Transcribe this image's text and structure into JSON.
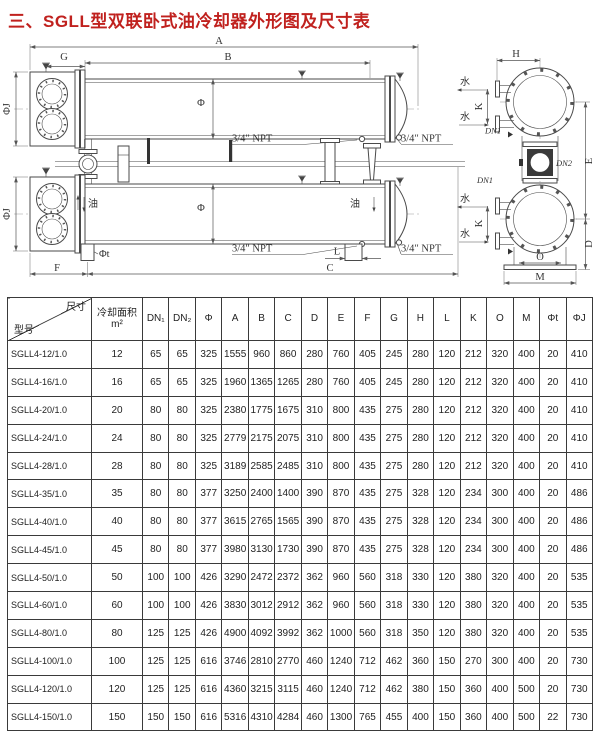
{
  "header": {
    "title": "三、SGLL型双联卧式油冷却器外形图及尺寸表",
    "title_color": "#c0211e"
  },
  "colors": {
    "line": "#4a4a4a",
    "table_border": "#3a3a3a",
    "background": "#ffffff"
  },
  "diagram": {
    "labels": {
      "A": "A",
      "B": "B",
      "G": "G",
      "C": "C",
      "F": "F",
      "L": "L",
      "H": "H",
      "K": "K",
      "D": "D",
      "E": "E",
      "O": "O",
      "M": "M",
      "phi": "Φ",
      "phiJ": "ΦJ",
      "phiT": "Φt",
      "dn1": "DN1",
      "dn2": "DN2",
      "npt": "3/4″ NPT",
      "water": "水",
      "oil": "油"
    }
  },
  "table": {
    "corner": {
      "top": "尺寸",
      "bottom": "型号"
    },
    "area_header": {
      "line1": "冷却面积",
      "line2": "m²"
    },
    "columns": [
      "DN₁",
      "DN₂",
      "Φ",
      "A",
      "B",
      "C",
      "D",
      "E",
      "F",
      "G",
      "H",
      "L",
      "K",
      "O",
      "M",
      "Φt",
      "ΦJ"
    ],
    "rows": [
      {
        "model": "SGLL4-12/1.0",
        "values": [
          12,
          65,
          65,
          325,
          1555,
          960,
          860,
          280,
          760,
          405,
          245,
          280,
          120,
          212,
          320,
          400,
          20,
          410
        ]
      },
      {
        "model": "SGLL4-16/1.0",
        "values": [
          16,
          65,
          65,
          325,
          1960,
          1365,
          1265,
          280,
          760,
          405,
          245,
          280,
          120,
          212,
          320,
          400,
          20,
          410
        ]
      },
      {
        "model": "SGLL4-20/1.0",
        "values": [
          20,
          80,
          80,
          325,
          2380,
          1775,
          1675,
          310,
          800,
          435,
          275,
          280,
          120,
          212,
          320,
          400,
          20,
          410
        ]
      },
      {
        "model": "SGLL4-24/1.0",
        "values": [
          24,
          80,
          80,
          325,
          2779,
          2175,
          2075,
          310,
          800,
          435,
          275,
          280,
          120,
          212,
          320,
          400,
          20,
          410
        ]
      },
      {
        "model": "SGLL4-28/1.0",
        "values": [
          28,
          80,
          80,
          325,
          3189,
          2585,
          2485,
          310,
          800,
          435,
          275,
          280,
          120,
          212,
          320,
          400,
          20,
          410
        ]
      },
      {
        "model": "SGLL4-35/1.0",
        "values": [
          35,
          80,
          80,
          377,
          3250,
          2400,
          1400,
          390,
          870,
          435,
          275,
          328,
          120,
          234,
          300,
          400,
          20,
          486
        ]
      },
      {
        "model": "SGLL4-40/1.0",
        "values": [
          40,
          80,
          80,
          377,
          3615,
          2765,
          1565,
          390,
          870,
          435,
          275,
          328,
          120,
          234,
          300,
          400,
          20,
          486
        ]
      },
      {
        "model": "SGLL4-45/1.0",
        "values": [
          45,
          80,
          80,
          377,
          3980,
          3130,
          1730,
          390,
          870,
          435,
          275,
          328,
          120,
          234,
          300,
          400,
          20,
          486
        ]
      },
      {
        "model": "SGLL4-50/1.0",
        "values": [
          50,
          100,
          100,
          426,
          3290,
          2472,
          2372,
          362,
          960,
          560,
          318,
          330,
          120,
          380,
          320,
          400,
          20,
          535
        ]
      },
      {
        "model": "SGLL4-60/1.0",
        "values": [
          60,
          100,
          100,
          426,
          3830,
          3012,
          2912,
          362,
          960,
          560,
          318,
          330,
          120,
          380,
          320,
          400,
          20,
          535
        ]
      },
      {
        "model": "SGLL4-80/1.0",
        "values": [
          80,
          125,
          125,
          426,
          4900,
          4092,
          3992,
          362,
          1000,
          560,
          318,
          350,
          120,
          380,
          320,
          400,
          20,
          535
        ]
      },
      {
        "model": "SGLL4-100/1.0",
        "values": [
          100,
          125,
          125,
          616,
          3746,
          2810,
          2770,
          460,
          1240,
          712,
          462,
          360,
          150,
          270,
          300,
          400,
          20,
          730
        ]
      },
      {
        "model": "SGLL4-120/1.0",
        "values": [
          120,
          125,
          125,
          616,
          4360,
          3215,
          3115,
          460,
          1240,
          712,
          462,
          380,
          150,
          360,
          400,
          500,
          20,
          730
        ]
      },
      {
        "model": "SGLL4-150/1.0",
        "values": [
          150,
          150,
          150,
          616,
          5316,
          4310,
          4284,
          460,
          1300,
          765,
          455,
          400,
          150,
          360,
          400,
          500,
          22,
          730
        ]
      }
    ]
  }
}
